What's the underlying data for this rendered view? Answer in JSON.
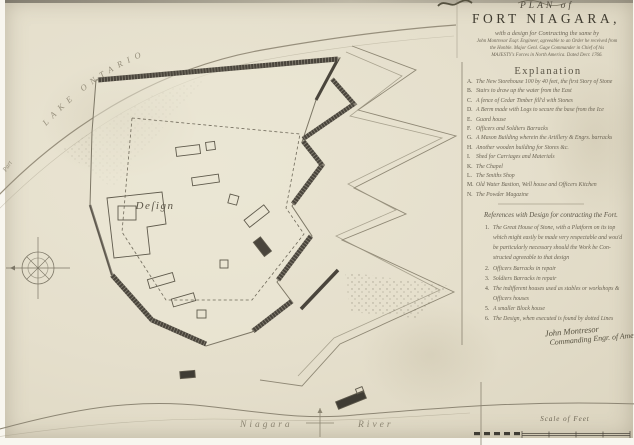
{
  "title": {
    "plan_of": "PLAN of",
    "fort_name": "FORT NIAGARA,",
    "subtitle_lines": [
      "with a design for Contracting the same by",
      "John Montresor Esqr. Engineer, agreeable to an Order he received from",
      "the Honble. Major Genl. Gage Commander in Chief of his",
      "MAJESTY's Forces in North America. Dated Decr. 1766."
    ]
  },
  "explanation": {
    "heading": "Explanation",
    "items": [
      {
        "letter": "A.",
        "text": "The New Storehouse 100 by 40 feet, the first Story of Stone"
      },
      {
        "letter": "B.",
        "text": "Stairs to draw up the water from the East"
      },
      {
        "letter": "C.",
        "text": "A fence of Cedar Timber fill'd with Stones"
      },
      {
        "letter": "D.",
        "text": "A Berm made with Logs to secure the base from the Ice"
      },
      {
        "letter": "E.",
        "text": "Guard house"
      },
      {
        "letter": "F.",
        "text": "Officers and Soldiers Barracks"
      },
      {
        "letter": "G.",
        "text": "A Mason Building wherein the Artillery & Engrs. barracks"
      },
      {
        "letter": "H.",
        "text": "Another wooden building for Stores &c."
      },
      {
        "letter": "I.",
        "text": "Shed for Carriages and Materials"
      },
      {
        "letter": "K.",
        "text": "The Chapel"
      },
      {
        "letter": "L.",
        "text": "The Smiths Shop"
      },
      {
        "letter": "M.",
        "text": "Old Water Bastion, Well house and Officers Kitchen"
      },
      {
        "letter": "N.",
        "text": "The Powder Magazine"
      }
    ]
  },
  "references": {
    "heading": "References with Design for contracting the Fort.",
    "items": [
      {
        "num": "1.",
        "lines": [
          "The Great House of Stone, with a Platform on its top",
          "which might easily be made very respectable and wou'd",
          "be particularly necessary should the Work be Con-",
          "structed agreeable to that design"
        ]
      },
      {
        "num": "2.",
        "lines": [
          "Officers Barracks in repair"
        ]
      },
      {
        "num": "3.",
        "lines": [
          "Soldiers Barracks in repair"
        ]
      },
      {
        "num": "4.",
        "lines": [
          "The indifferent houses used as stables or workshops &",
          "Officers houses"
        ]
      },
      {
        "num": "5.",
        "lines": [
          "A smaller Block house"
        ]
      },
      {
        "num": "6.",
        "lines": [
          "The Design, when executed is found by dotted Lines"
        ]
      }
    ]
  },
  "signature": {
    "line1": "John Montresor",
    "line2": "Commanding Engr. of America"
  },
  "map_labels": {
    "lake": "LAKE ONTARIO",
    "part": "Part",
    "design": "Deſign",
    "river_word1": "Niagara",
    "river_word2": "River",
    "scale": "Scale of Feet"
  },
  "colors": {
    "paper": "#e5dfcc",
    "ink": "#5d5749",
    "rampart_dark": "#46423a"
  }
}
